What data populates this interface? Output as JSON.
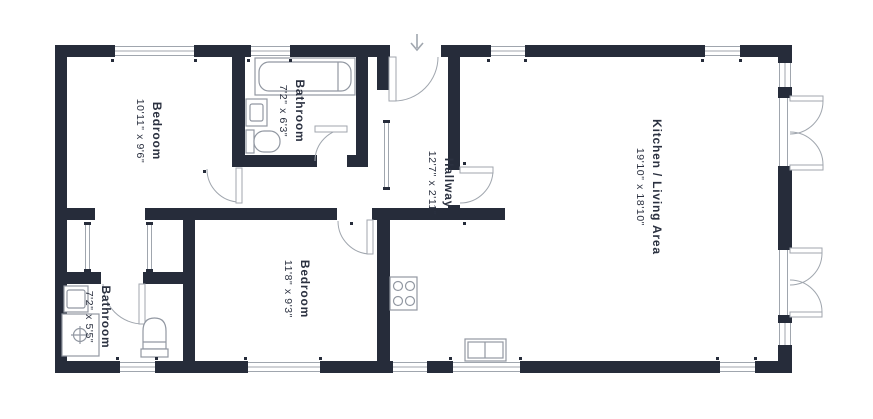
{
  "colors": {
    "wall": "#262c3a",
    "line": "#a0a6ae",
    "fixture": "#9298a2",
    "text": "#2b3140",
    "bg": "#ffffff"
  },
  "rooms": [
    {
      "id": "bedroom-1",
      "name": "Bedroom",
      "dims": "10'11\" x 9'6\""
    },
    {
      "id": "bathroom-top",
      "name": "Bathroom",
      "dims": "7'2\" x 6'3\""
    },
    {
      "id": "hallway",
      "name": "Hallway",
      "dims": "12'7\" x 2'11\""
    },
    {
      "id": "kitchen-living",
      "name": "Kitchen / Living Area",
      "dims": "19'10\" x 18'10\""
    },
    {
      "id": "bedroom-2",
      "name": "Bedroom",
      "dims": "11'8\" x 9'3\""
    },
    {
      "id": "bathroom-ensuite",
      "name": "Bathroom",
      "dims": "7'2\" x 5'5\""
    }
  ],
  "icons": {
    "entry_arrow": "down-arrow",
    "fixtures": [
      "bathtub",
      "toilet",
      "sink",
      "shower",
      "stove",
      "kitchen-sink",
      "wardrobe-sliding-door"
    ]
  }
}
